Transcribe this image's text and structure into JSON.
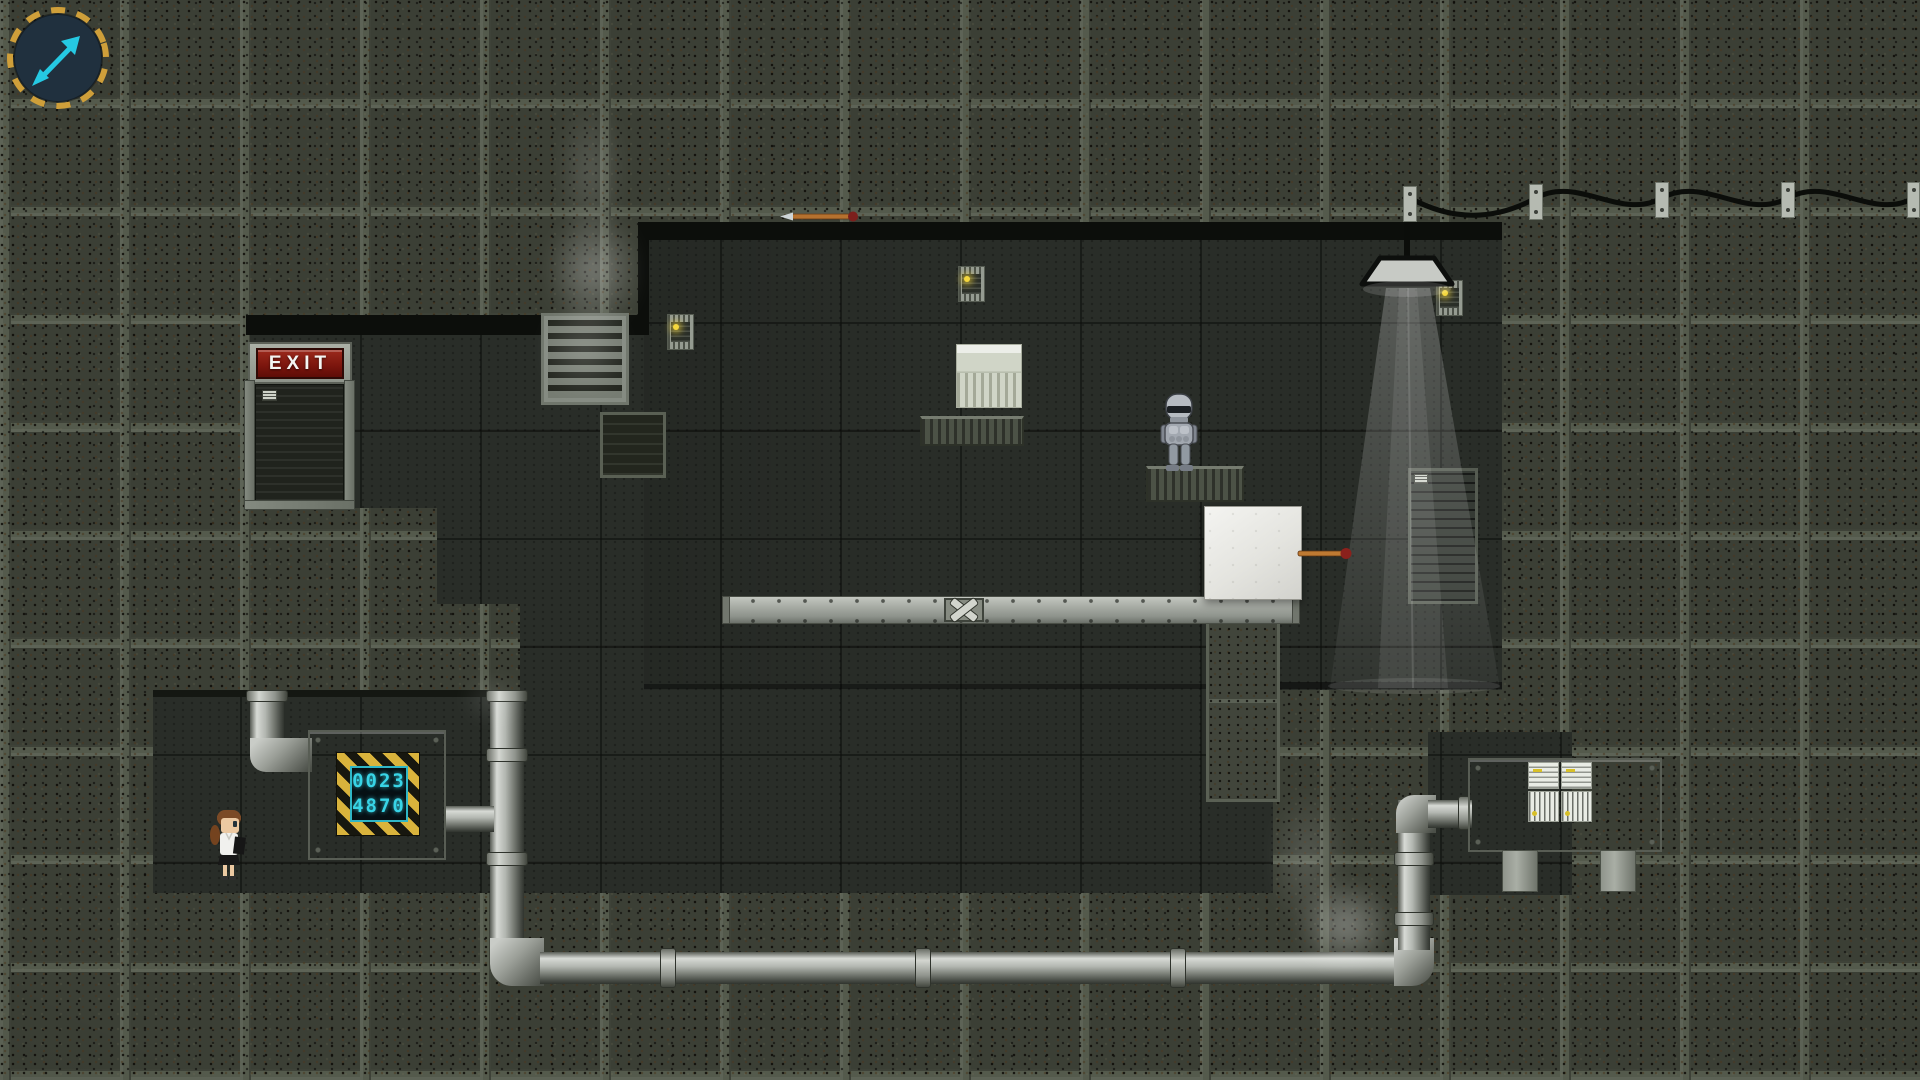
{
  "hud": {
    "aim_indicator": {
      "direction": "up-right",
      "arrow_color": "#25c9e3",
      "ring_color": "#cf9f3a"
    }
  },
  "signs": {
    "exit": {
      "label": "EXIT"
    }
  },
  "machines": {
    "counter": {
      "line1": "0023",
      "line2": "4870",
      "digit_color": "#38d4e6",
      "frame_style": "hazard-stripes"
    },
    "control_panel": {
      "indicator_color": "#d8c028",
      "panel_count": 4
    }
  },
  "characters": {
    "player": {
      "name": "scientist-girl",
      "hair_color": "#7b4a26",
      "coat_color": "#f1f1ee"
    },
    "npc": {
      "name": "robot",
      "armor_color": "#a2a8b0"
    }
  },
  "objects": {
    "darts": {
      "count": 2,
      "shaft_color": "#bf7a32",
      "knob_color": "#8a211c"
    },
    "white_box": {
      "count": 1
    },
    "lamp": {
      "count": 1,
      "light_on": true
    },
    "vent": {
      "count": 1
    },
    "poster": {
      "count": 1
    },
    "power_cable_brackets": {
      "count": 5
    }
  },
  "palette": {
    "wall_tile": "#3b3f35",
    "room_interior": "#292d28",
    "pipe_metal": "#b3b7b1",
    "machine_gray": "#9aa095",
    "exit_red": "#7a150d",
    "led_yellow": "#f4d73e"
  }
}
